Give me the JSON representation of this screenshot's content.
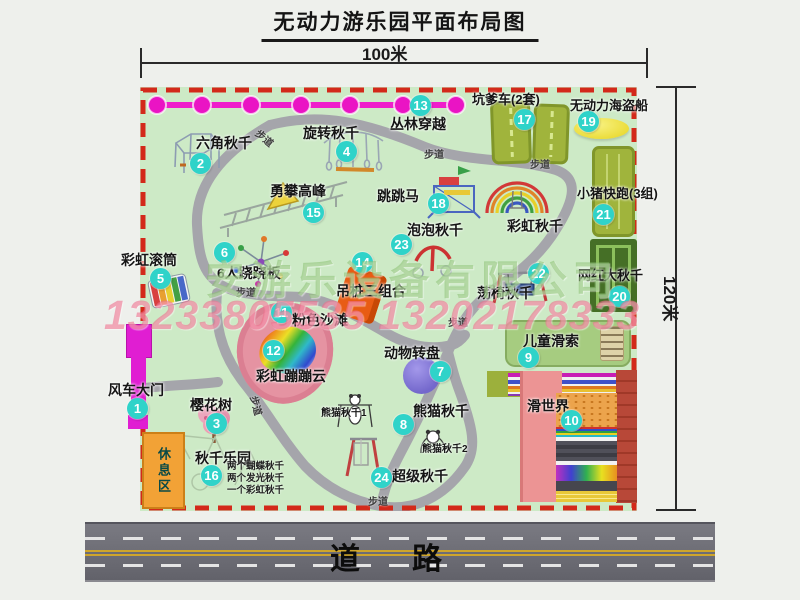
{
  "title": "无动力游乐园平面布局图",
  "dimensions": {
    "width": "100米",
    "height": "120米"
  },
  "road_label": "道路",
  "trail_label": "步道",
  "watermark": {
    "company": "安游乐设备有限公司",
    "phone": "13233805535 13202178333"
  },
  "items": [
    {
      "num": "1",
      "label": "风车大门"
    },
    {
      "num": "2",
      "label": "六角秋千"
    },
    {
      "num": "3",
      "label": "樱花树"
    },
    {
      "num": "4",
      "label": "旋转秋千"
    },
    {
      "num": "5",
      "label": "彩虹滚筒"
    },
    {
      "num": "6",
      "label": "6人跷跷板"
    },
    {
      "num": "7",
      "label": "动物转盘"
    },
    {
      "num": "8",
      "label": "熊猫秋千"
    },
    {
      "num": "9",
      "label": "儿童滑索"
    },
    {
      "num": "10",
      "label": "滑世界"
    },
    {
      "num": "11",
      "label": "粉色沙滩"
    },
    {
      "num": "12",
      "label": "彩虹蹦蹦云"
    },
    {
      "num": "13",
      "label": "丛林穿越"
    },
    {
      "num": "14",
      "label": "吊桩三组合"
    },
    {
      "num": "15",
      "label": "勇攀高峰"
    },
    {
      "num": "16",
      "label": "秋千乐园"
    },
    {
      "num": "17",
      "label": "坑爹车(2套)"
    },
    {
      "num": "18",
      "label": "跳跳马"
    },
    {
      "num": "19",
      "label": "无动力海盗船"
    },
    {
      "num": "20",
      "label": "网红大秋千"
    },
    {
      "num": "21",
      "label": "小猪快跑(3组)"
    },
    {
      "num": "22",
      "label": "荡椅秋千"
    },
    {
      "num": "23",
      "label": "泡泡秋千"
    },
    {
      "num": "24",
      "label": "超级秋千"
    }
  ],
  "extras": {
    "rainbow_swing": "彩虹秋千",
    "rest_area": "休息区",
    "panda_swing_1": "熊猫秋千1",
    "panda_swing_2": "熊猫秋千2",
    "swing_notes": [
      "两个蝴蝶秋千",
      "两个发光秋千",
      "一个彩虹秋千"
    ]
  },
  "colors": {
    "map_bg": "#cdeac6",
    "border": "#d3291a",
    "badge": "#2fd3c9",
    "zipline": "#ea1bca",
    "road": "#6b6b73"
  }
}
